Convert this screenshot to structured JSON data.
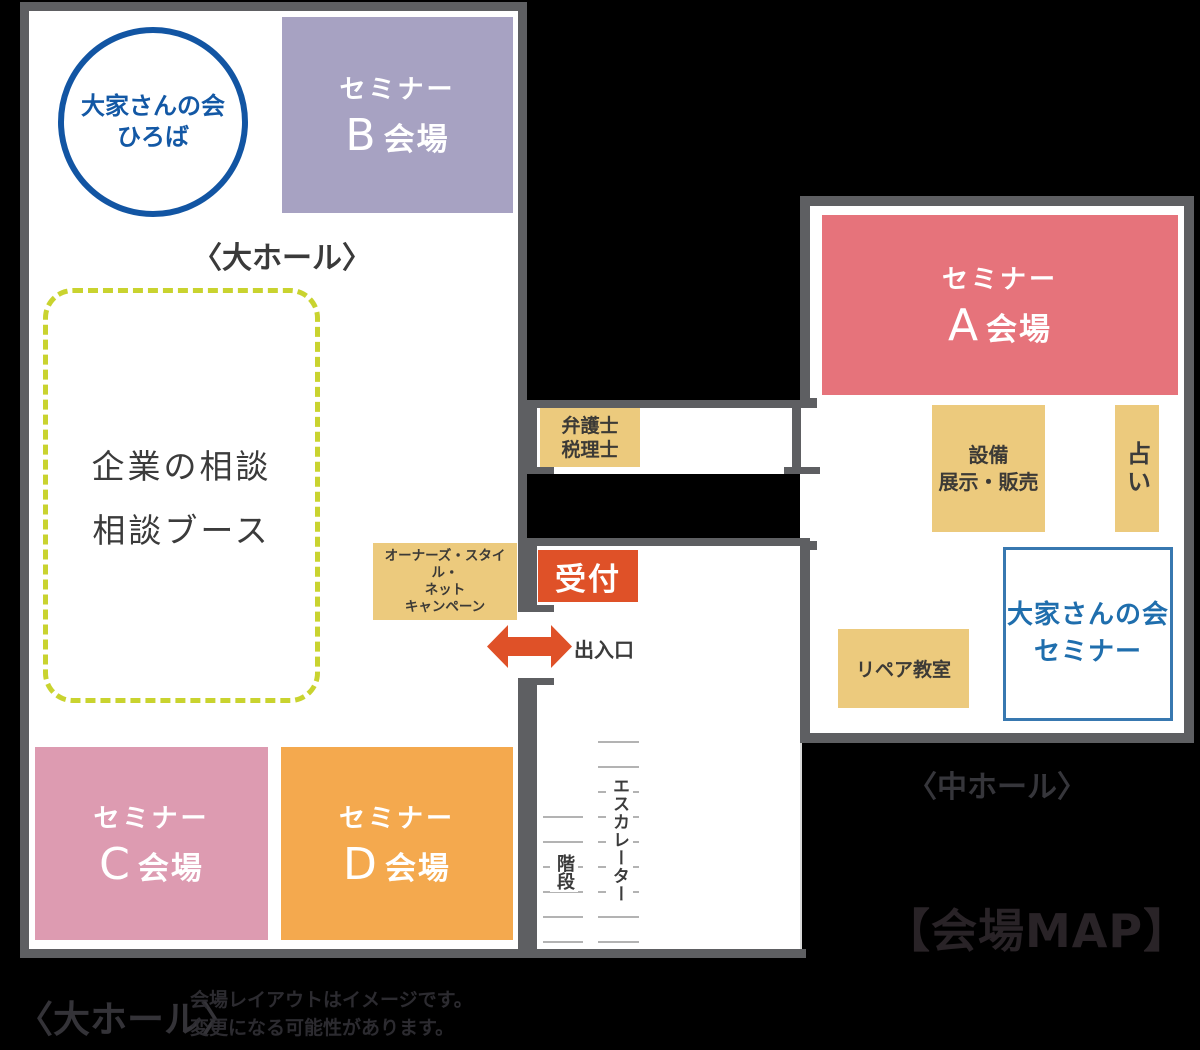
{
  "map_title": "【会場MAP】",
  "colors": {
    "background": "#000000",
    "wall_gray": "#5e5f62",
    "hall_floor": "#ffffff",
    "seminar_a": "#e6737b",
    "seminar_b": "#a7a2c2",
    "seminar_c": "#dd9bb1",
    "seminar_d": "#f4a94e",
    "booth_tan": "#ecca7d",
    "reception_red": "#df5128",
    "arrow_red": "#df5128",
    "blue_accent": "#1358a5",
    "ooya_box_border": "#3878b0",
    "consult_dash_green": "#c9d32f",
    "step_line_gray": "#b3b3b3",
    "dark_text": "#3b3b3b"
  },
  "large_hall": {
    "inner_label": "〈大ホール〉",
    "hiroba_circle": {
      "line1": "大家さんの会",
      "line2": "ひろば"
    },
    "seminar_b": {
      "prefix": "セミナー",
      "letter": "B",
      "suffix": "会場"
    },
    "consult_booth": {
      "line1": "企業の相談",
      "line2": "相談ブース"
    },
    "seminar_c": {
      "prefix": "セミナー",
      "letter": "C",
      "suffix": "会場"
    },
    "seminar_d": {
      "prefix": "セミナー",
      "letter": "D",
      "suffix": "会場"
    },
    "owners_style": {
      "line1": "オーナーズ・スタイル・",
      "line2": "ネット",
      "line3": "キャンペーン"
    }
  },
  "corridor": {
    "lawyer_box": {
      "line1": "弁護士",
      "line2": "税理士"
    },
    "reception": "受付",
    "entrance": "出入口",
    "escalator": "エスカレーター",
    "stairs": "階段"
  },
  "middle_hall": {
    "outer_label": "〈中ホール〉",
    "seminar_a": {
      "prefix": "セミナー",
      "letter": "A",
      "suffix": "会場"
    },
    "equipment": {
      "line1": "設備",
      "line2": "展示・販売"
    },
    "fortune": "占い",
    "repair": "リペア教室",
    "ooya_seminar": {
      "line1": "大家さんの会",
      "line2": "セミナー"
    }
  },
  "footer": {
    "hall_label": "〈大ホール〉",
    "note_line1": "会場レイアウトはイメージです。",
    "note_line2": "変更になる可能性があります。"
  }
}
